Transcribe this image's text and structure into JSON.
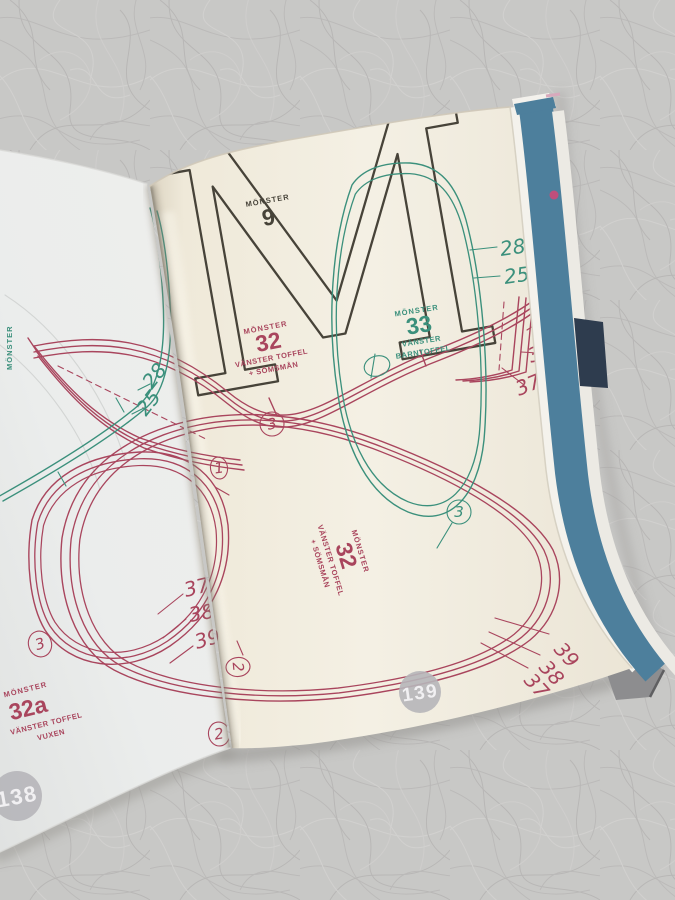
{
  "pages": {
    "left_number": "138",
    "right_number": "139"
  },
  "letterform": "M",
  "labels": {
    "pattern_9": {
      "eyebrow": "MÖNSTER",
      "number": "9"
    },
    "pattern_32": {
      "eyebrow": "MÖNSTER",
      "number": "32",
      "line1": "VÄNSTER TOFFEL",
      "line2": "+ SÖMSMÅN"
    },
    "pattern_33": {
      "eyebrow": "MÖNSTER",
      "number": "33",
      "line1": "VÄNSTER",
      "line2": "BARNTOFFEL"
    },
    "pattern_32a": {
      "eyebrow": "MÖNSTER",
      "number": "32a",
      "line1": "VÄNSTER TOFFEL",
      "line2": "VUXEN"
    },
    "spine_label": "MÖNSTER"
  },
  "sizes": {
    "green_right": [
      "28",
      "25"
    ],
    "green_left": [
      "28",
      "25"
    ],
    "red_heel_right": [
      "39",
      "38",
      "37"
    ],
    "red_toe_right": [
      "39",
      "38",
      "37"
    ],
    "red_left_stack": [
      "37",
      "38",
      "39"
    ]
  },
  "marks": {
    "one": "1",
    "two": "2",
    "three": "3"
  },
  "colors": {
    "red": "#a9455d",
    "green": "#3b907c",
    "dark": "#474339",
    "cover_blue": "#4d7f9c",
    "navy": "#2e3c4e",
    "badge": "#b6b5b9",
    "page_cream": "#f2eee1",
    "page_left": "#ebedec",
    "background": "#c9c8c6"
  }
}
